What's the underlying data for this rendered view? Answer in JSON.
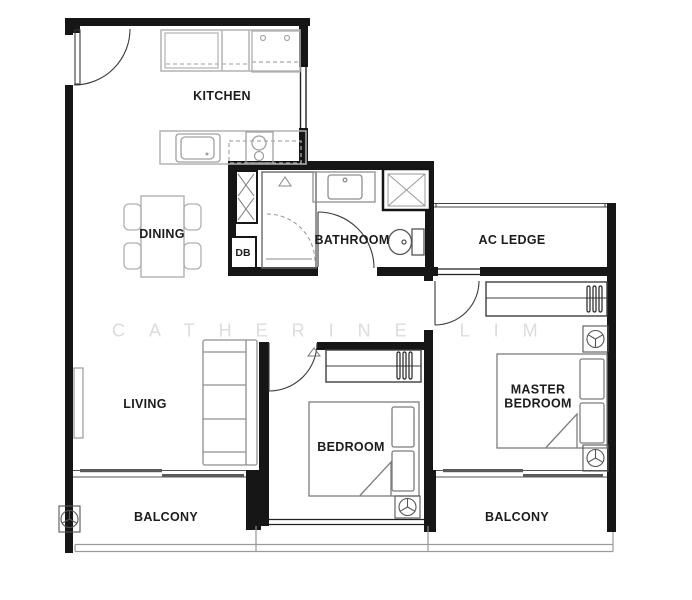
{
  "watermark": {
    "text": "CATHERINE LIM"
  },
  "rooms": {
    "kitchen": "KITCHEN",
    "dining": "DINING",
    "bathroom": "BATHROOM",
    "ac_ledge": "AC LEDGE",
    "living": "LIVING",
    "bedroom": "BEDROOM",
    "master_bedroom": "MASTER BEDROOM",
    "balcony_left": "BALCONY",
    "balcony_right": "BALCONY"
  },
  "labels": {
    "db_box": "DB"
  },
  "colors": {
    "background": "#ffffff",
    "wall": "#161616",
    "furniture_gray": "#8f8f8f",
    "counter_gray": "#b2b2b2",
    "door_arc": "#3a3a3a",
    "watermark_gray": "#dcdcdc",
    "label_black": "#1c1c1c"
  },
  "symbols": [
    "entrance-door-swing",
    "bathroom-door-swing",
    "bedroom-door-swing",
    "master-bedroom-door-swing",
    "closet-dashed-swing",
    "kitchen-sink",
    "cooktop-hob",
    "fridge-unit",
    "utility-cabinet-x",
    "shower-stall-x",
    "toilet-wc",
    "vanity-basin",
    "dining-table-four-chairs",
    "sofa-three-seat",
    "tv-console",
    "double-bed-with-pillows",
    "wardrobe-hanging-rail",
    "ceiling-fan-light",
    "sliding-balcony-door",
    "balcony-railing",
    "window-double-line"
  ]
}
